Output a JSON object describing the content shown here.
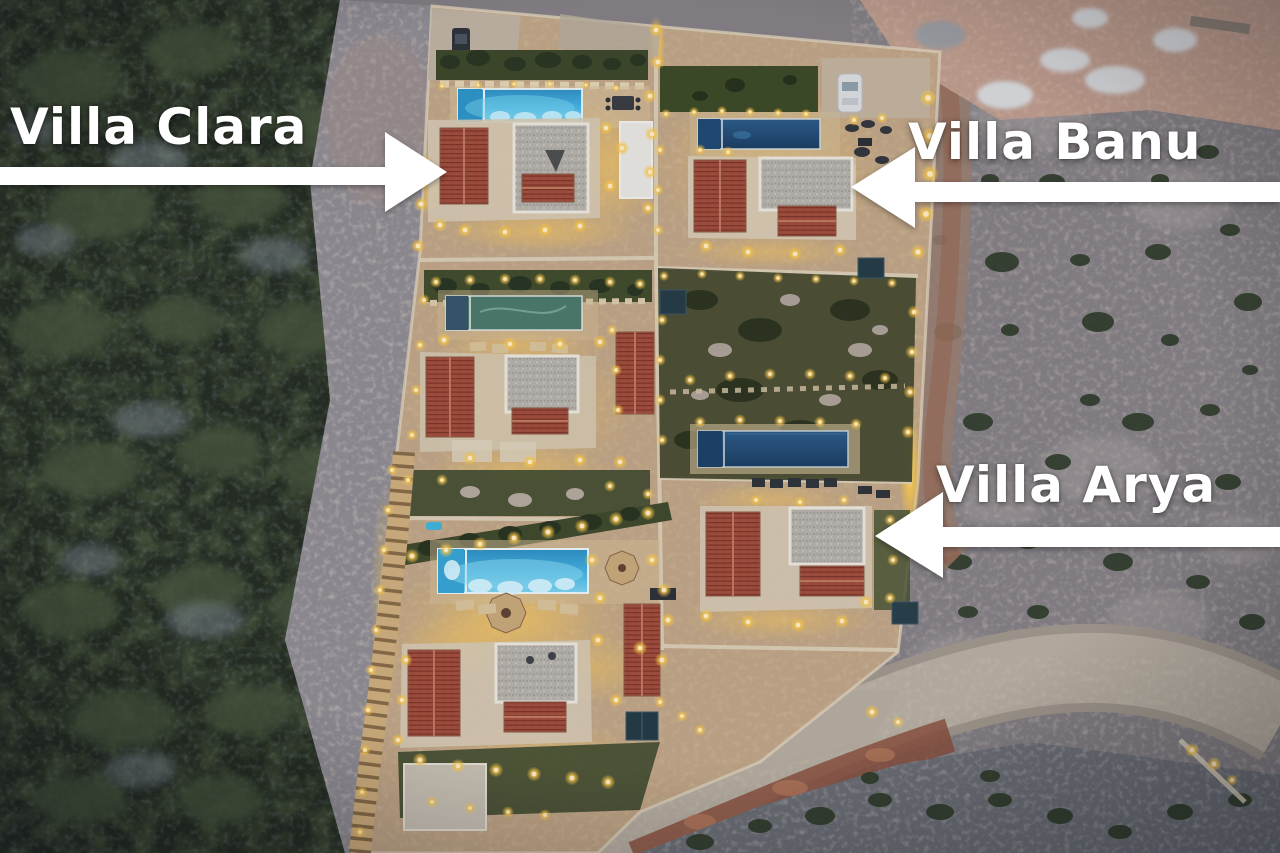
{
  "annotations": [
    {
      "id": "villa-clara",
      "label": "Villa Clara",
      "arrow_direction": "right"
    },
    {
      "id": "villa-banu",
      "label": "Villa Banu",
      "arrow_direction": "left"
    },
    {
      "id": "villa-arya",
      "label": "Villa Arya",
      "arrow_direction": "left"
    }
  ],
  "palette": {
    "annotation_text": "#ffffff",
    "arrow_fill": "#ffffff",
    "pool_lit": "#4fc0e8",
    "pool_unlit": "#24507c",
    "pool_covered_green": "#4b7a6b",
    "roof_terracotta": "#a24e3d",
    "roof_gray": "#b6b2aa",
    "terrace_stone": "#c0a585",
    "night_lighting": "#fbc94a",
    "vegetation_dark": "#242c21",
    "rocky_ground": "#8b8689",
    "road_concrete": "#b3a99a"
  }
}
